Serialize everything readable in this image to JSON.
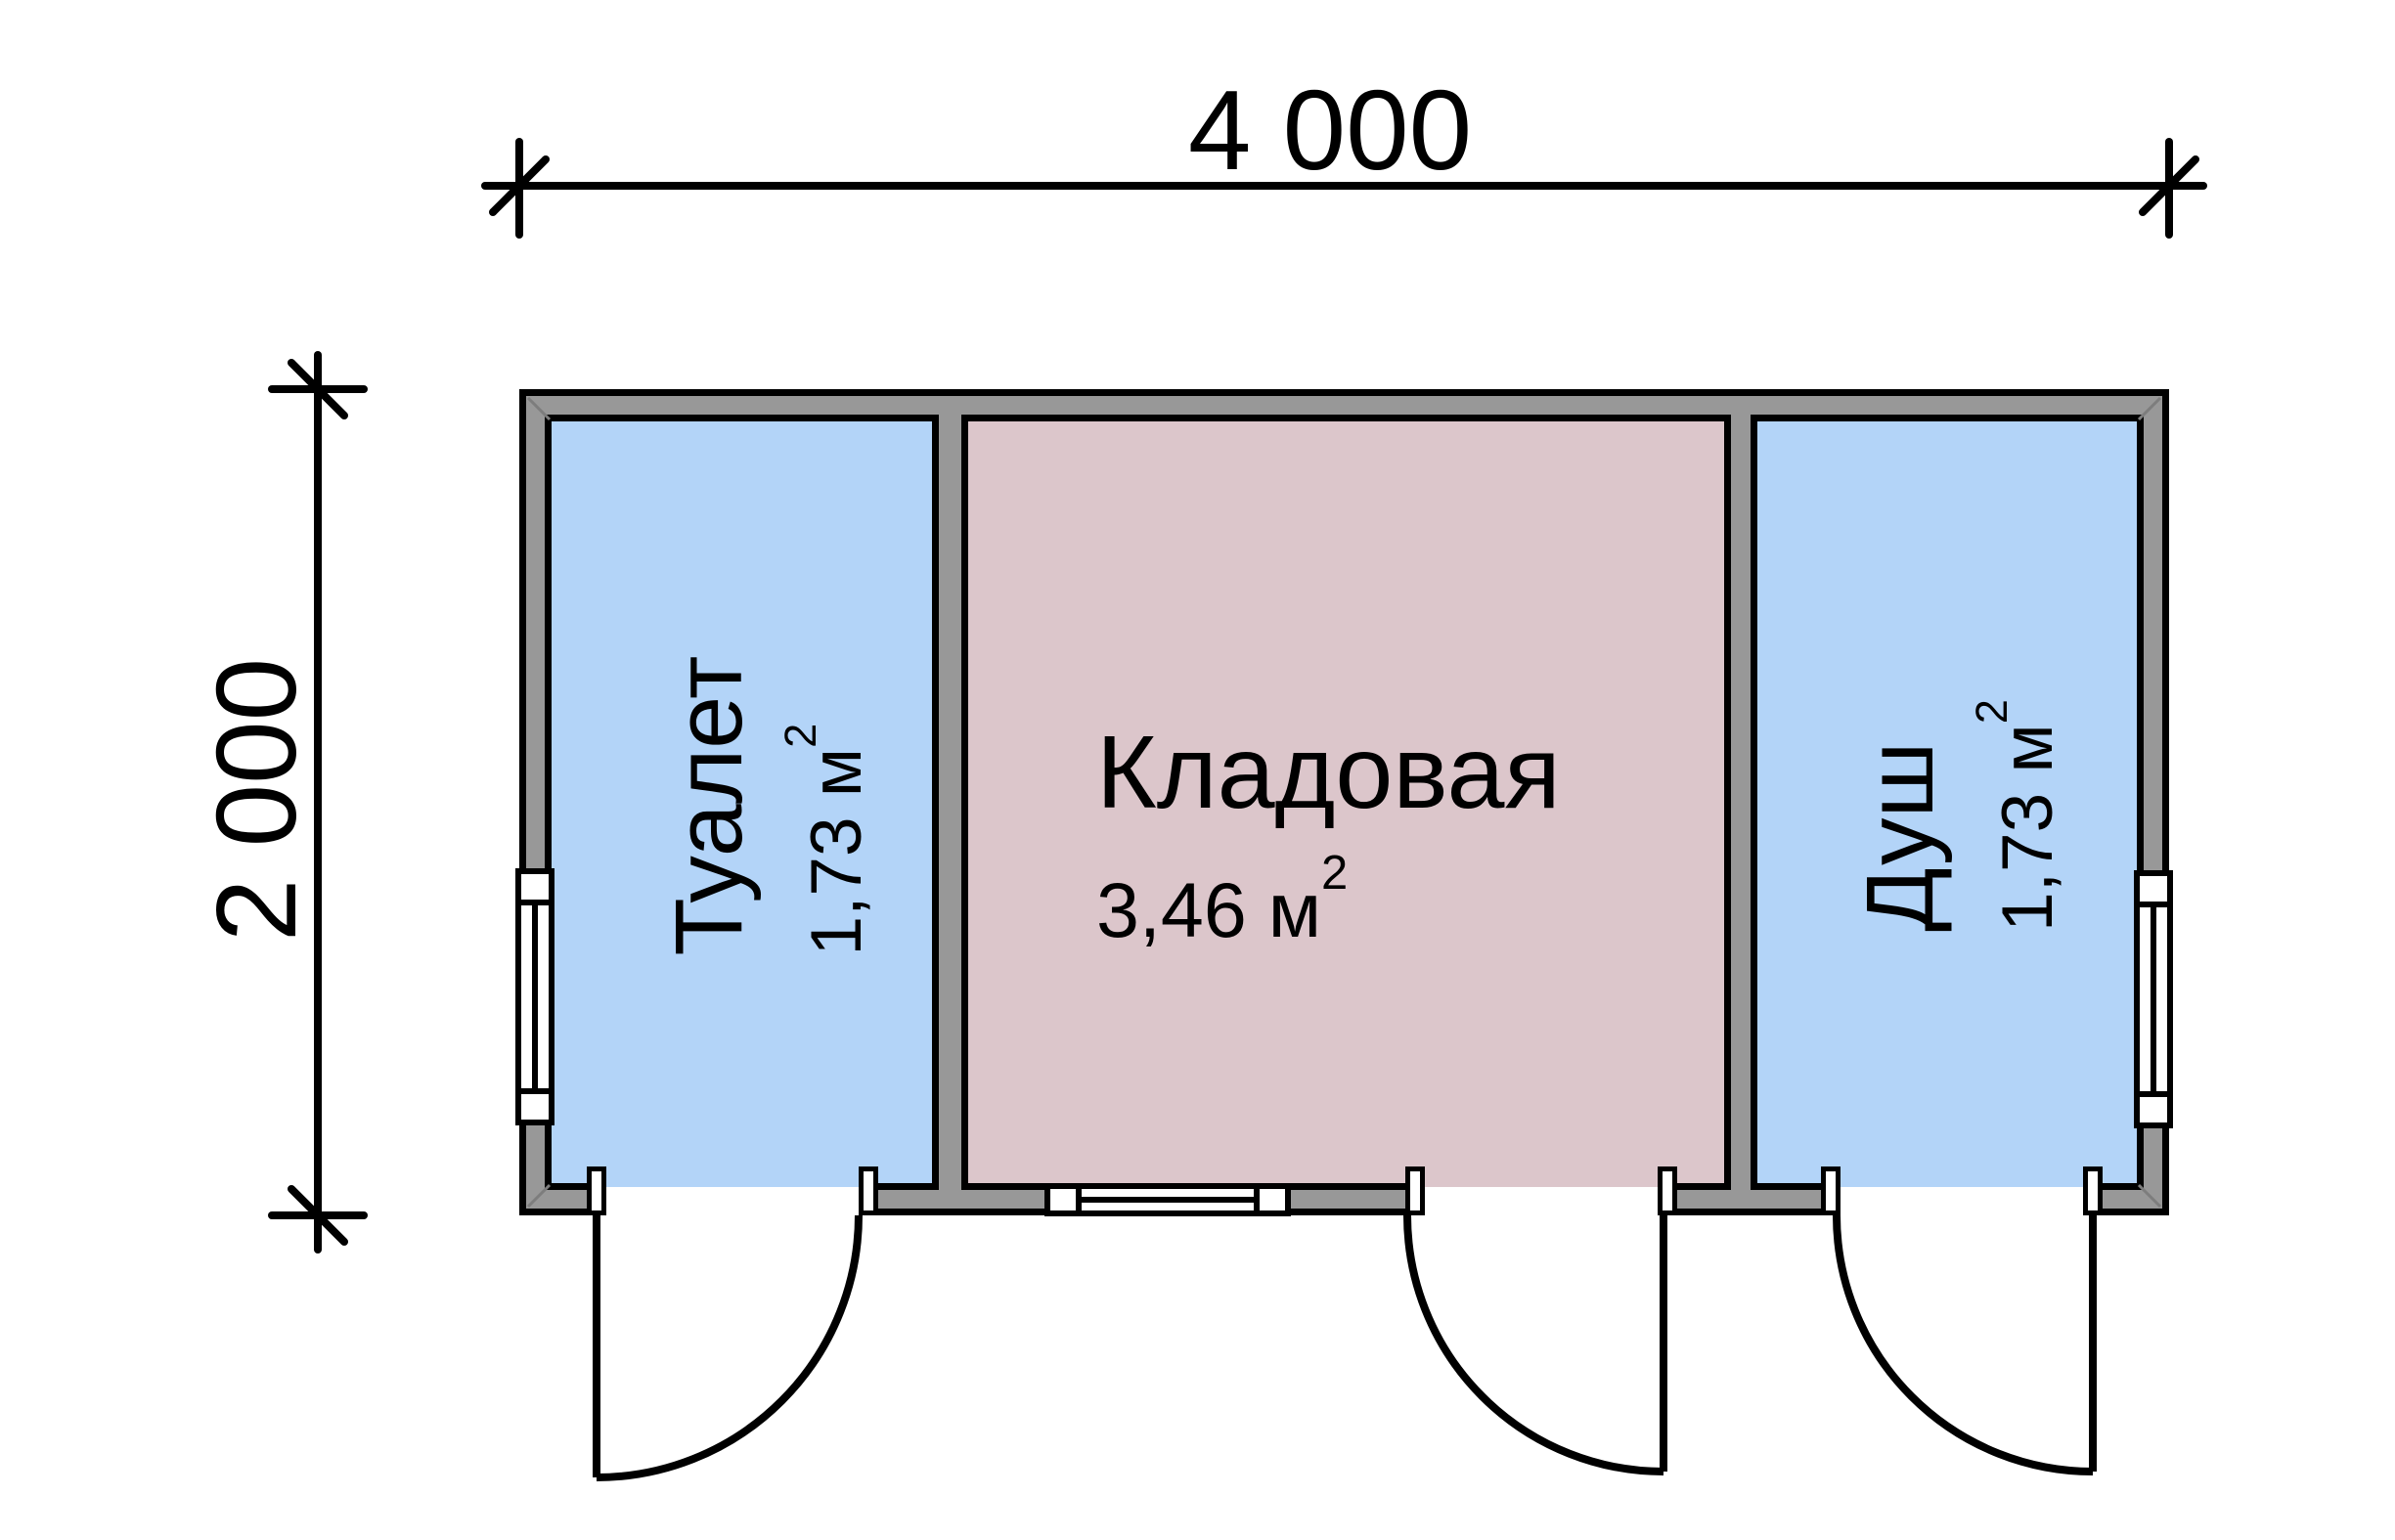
{
  "dimensions": {
    "width_label": "4 000",
    "height_label": "2 000"
  },
  "rooms": [
    {
      "id": "toilet",
      "name": "Туалет",
      "area_value": "1,73 м",
      "area_sup": "2",
      "fill": "#b3d4f8"
    },
    {
      "id": "storage",
      "name": "Кладовая",
      "area_value": "3,46 м",
      "area_sup": "2",
      "fill": "#dcc6cb"
    },
    {
      "id": "shower",
      "name": "Душ",
      "area_value": "1,73 м",
      "area_sup": "2",
      "fill": "#b3d4f8"
    }
  ],
  "colors": {
    "wall_fill": "#989898",
    "line": "#000000",
    "window_fill": "#ffffff",
    "background": "#ffffff",
    "miter_line": "#7d7d7d"
  }
}
